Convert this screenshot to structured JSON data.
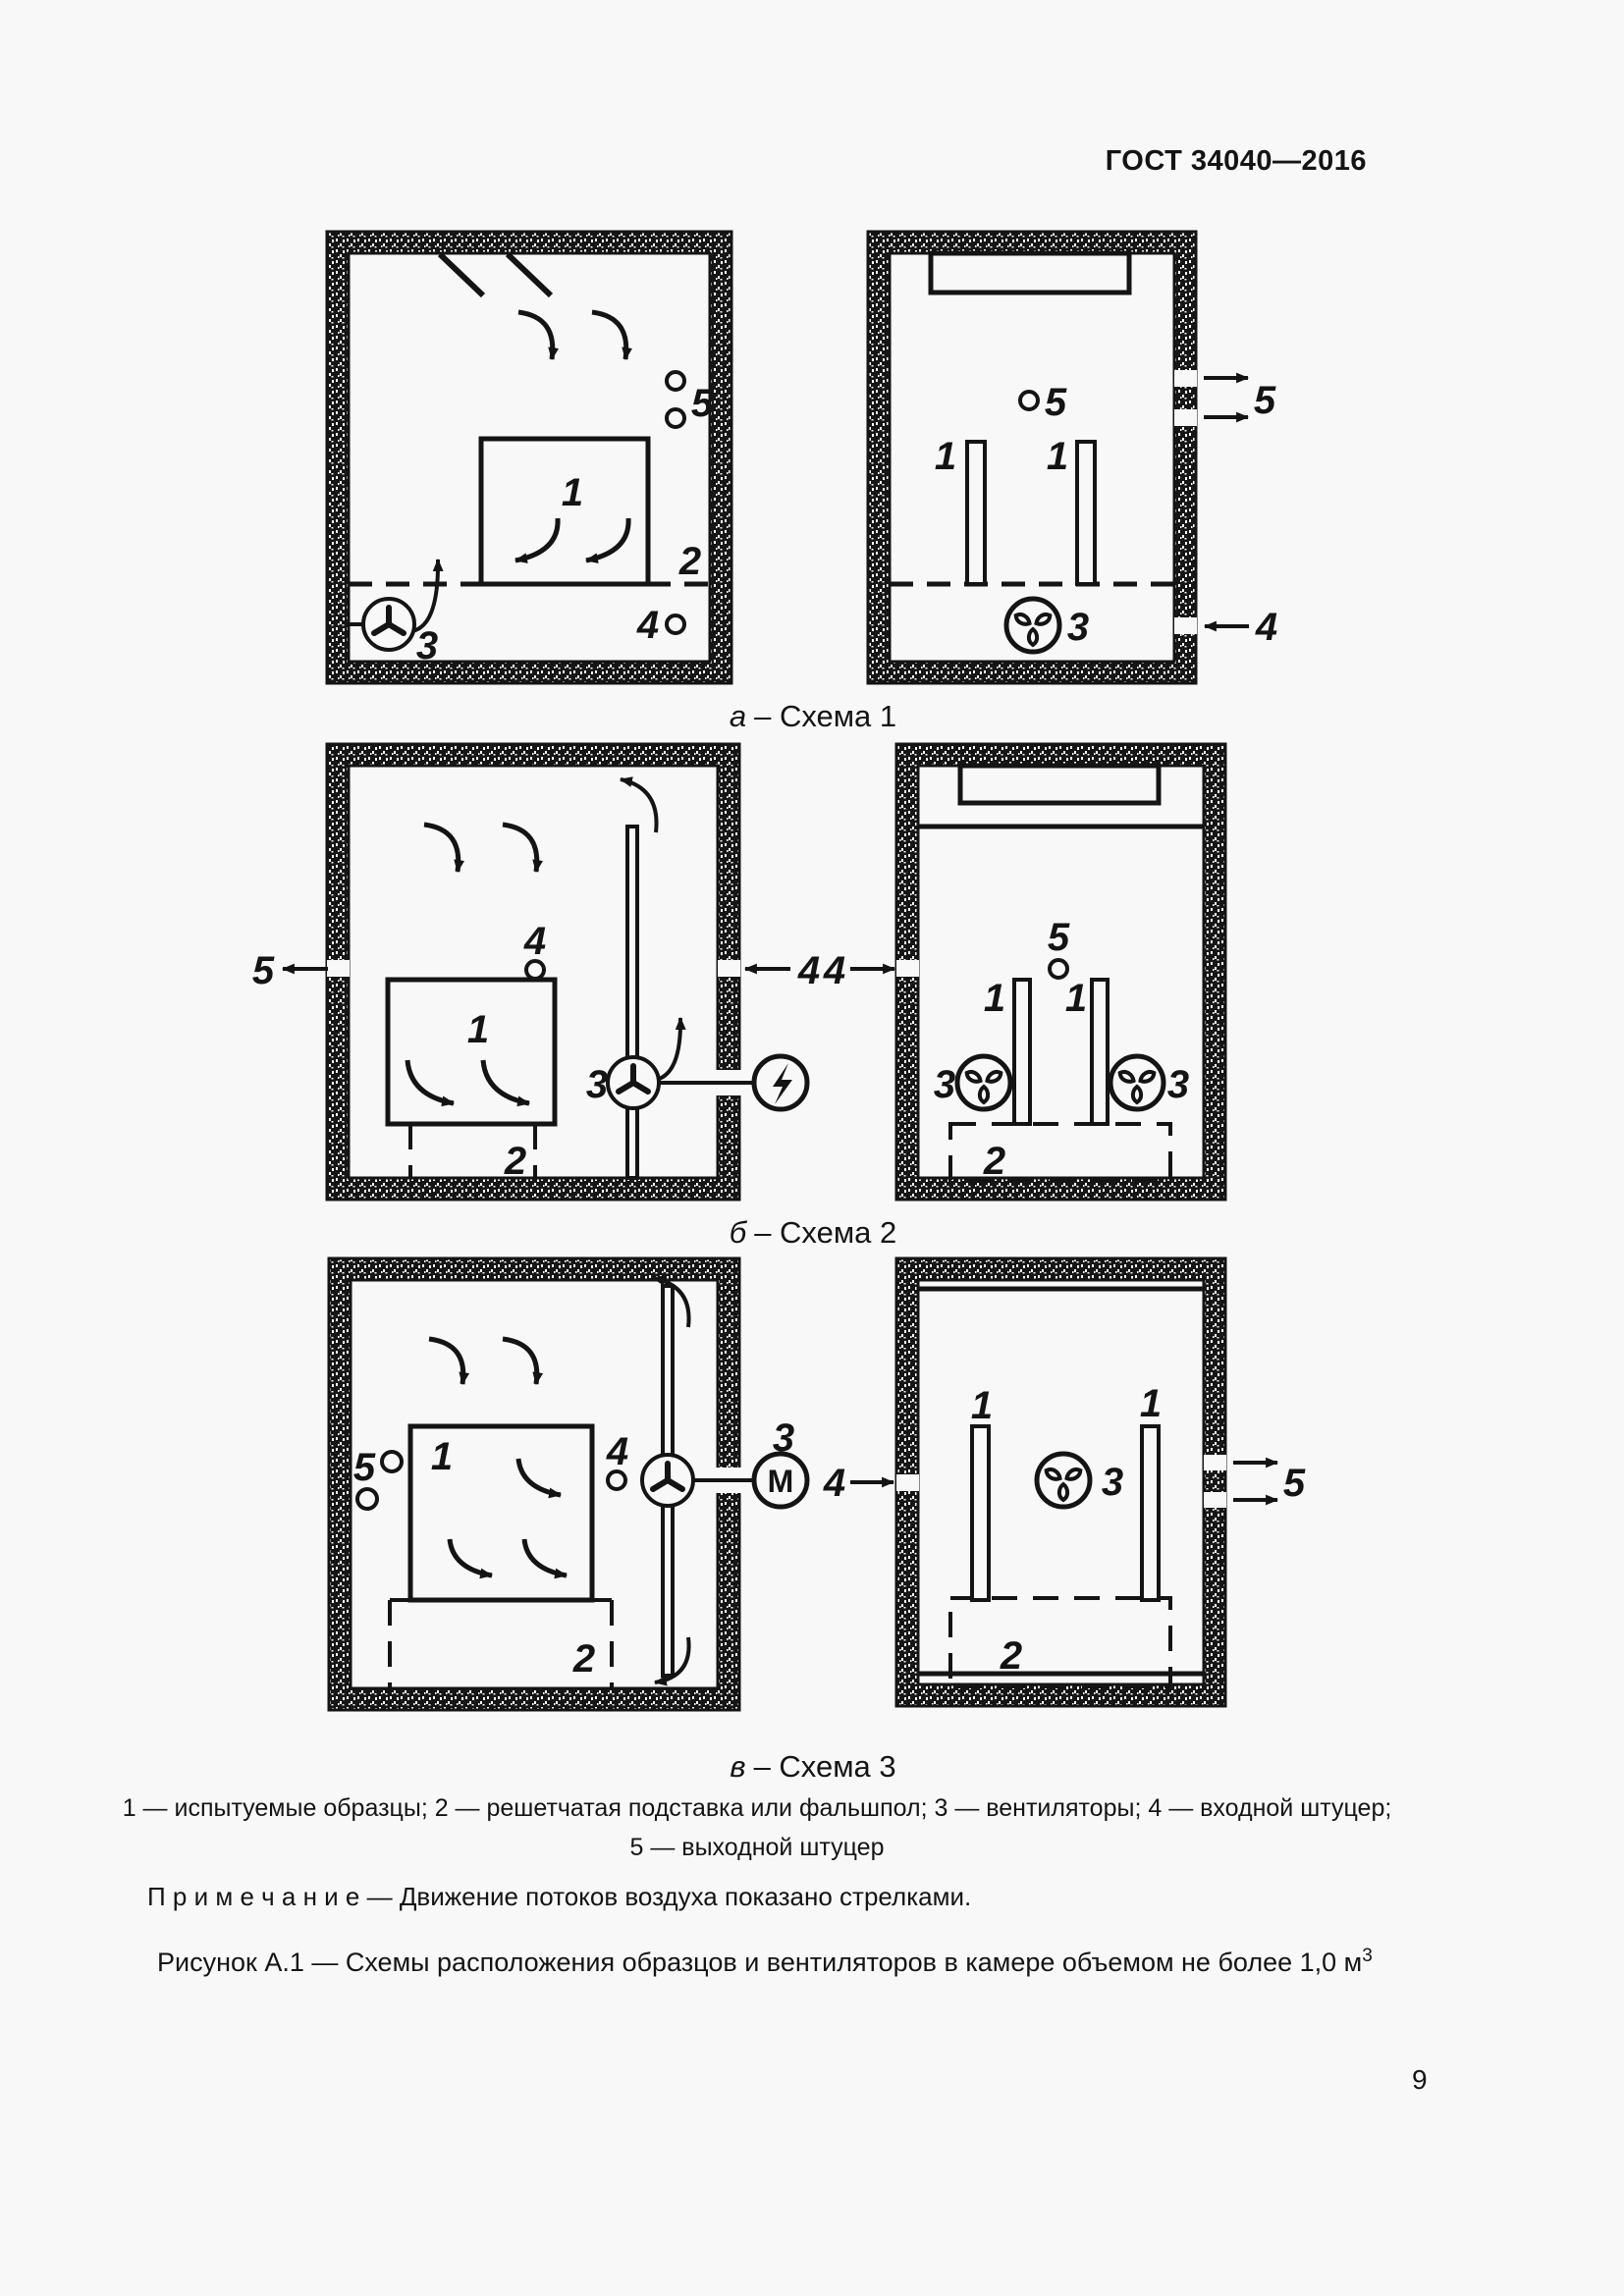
{
  "page": {
    "header": "ГОСТ 34040—2016",
    "number": "9"
  },
  "labels": {
    "pos1": "1",
    "pos2": "2",
    "pos3": "3",
    "pos4": "4",
    "pos5": "5",
    "motor": "М"
  },
  "captions": {
    "a_letter": "а",
    "a_text": "– Схема 1",
    "b_letter": "б",
    "b_text": "– Схема 2",
    "v_letter": "в",
    "v_text": "– Схема 3"
  },
  "legend": {
    "line1": "1 — испытуемые образцы; 2 — решетчатая подставка или фальшпол; 3 — вентиляторы; 4 — входной штуцер;",
    "line2": "5 — выходной штуцер"
  },
  "note": "П р и м е ч а н и е — Движение потоков воздуха показано стрелками.",
  "figure": {
    "caption": "Рисунок А.1 — Схемы расположения образцов и вентиляторов в камере объемом не более 1,0 м",
    "sup": "3"
  }
}
